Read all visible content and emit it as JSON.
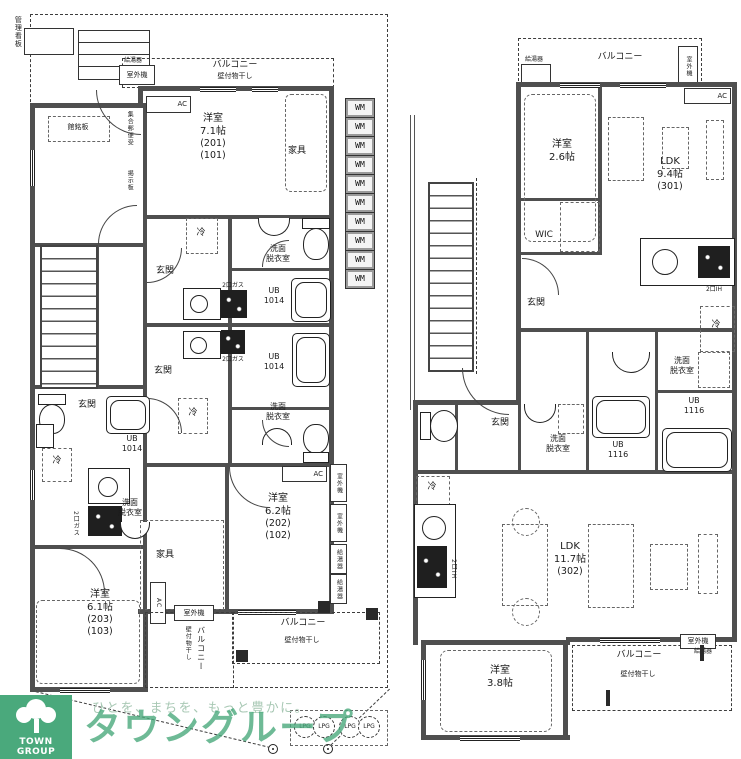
{
  "brand": {
    "logo_text": "TOWN GROUP",
    "slogan": "ひとを、まちを、もっと豊かに。",
    "name": "タウングループ",
    "green": "#4aa97c",
    "slogan_color": "#a8c8b4"
  },
  "labels": {
    "balcony": "バルコニー",
    "wall_hanger": "壁付物干し",
    "water_heater": "給湯器",
    "outdoor_unit": "室外機",
    "ac": "AC",
    "wm": "WM",
    "lpg": "LPG",
    "furniture": "家具",
    "entrance": "玄関",
    "fridge": "冷",
    "washroom": "洗面\n脱衣室",
    "ub1014": "UB\n1014",
    "ub1116": "UB\n1116",
    "gas2": "2口ガス",
    "ih2": "2口IH",
    "wic": "WIC",
    "mgmt_sign": "管理看板",
    "name_plate": "館銘板",
    "notice_board": "掲示板",
    "mailbox": "集合郵便受"
  },
  "rooms": {
    "r201": {
      "type": "洋室",
      "size": "7.1帖",
      "id1": "(201)",
      "id2": "(101)"
    },
    "r202": {
      "type": "洋室",
      "size": "6.2帖",
      "id1": "(202)",
      "id2": "(102)"
    },
    "r203": {
      "type": "洋室",
      "size": "6.1帖",
      "id1": "(203)",
      "id2": "(103)"
    },
    "r301bed": {
      "type": "洋室",
      "size": "2.6帖"
    },
    "r301ldk": {
      "type": "LDK",
      "size": "9.4帖",
      "id1": "(301)"
    },
    "r302ldk": {
      "type": "LDK",
      "size": "11.7帖",
      "id1": "(302)"
    },
    "r302bed": {
      "type": "洋室",
      "size": "3.8帖"
    }
  }
}
